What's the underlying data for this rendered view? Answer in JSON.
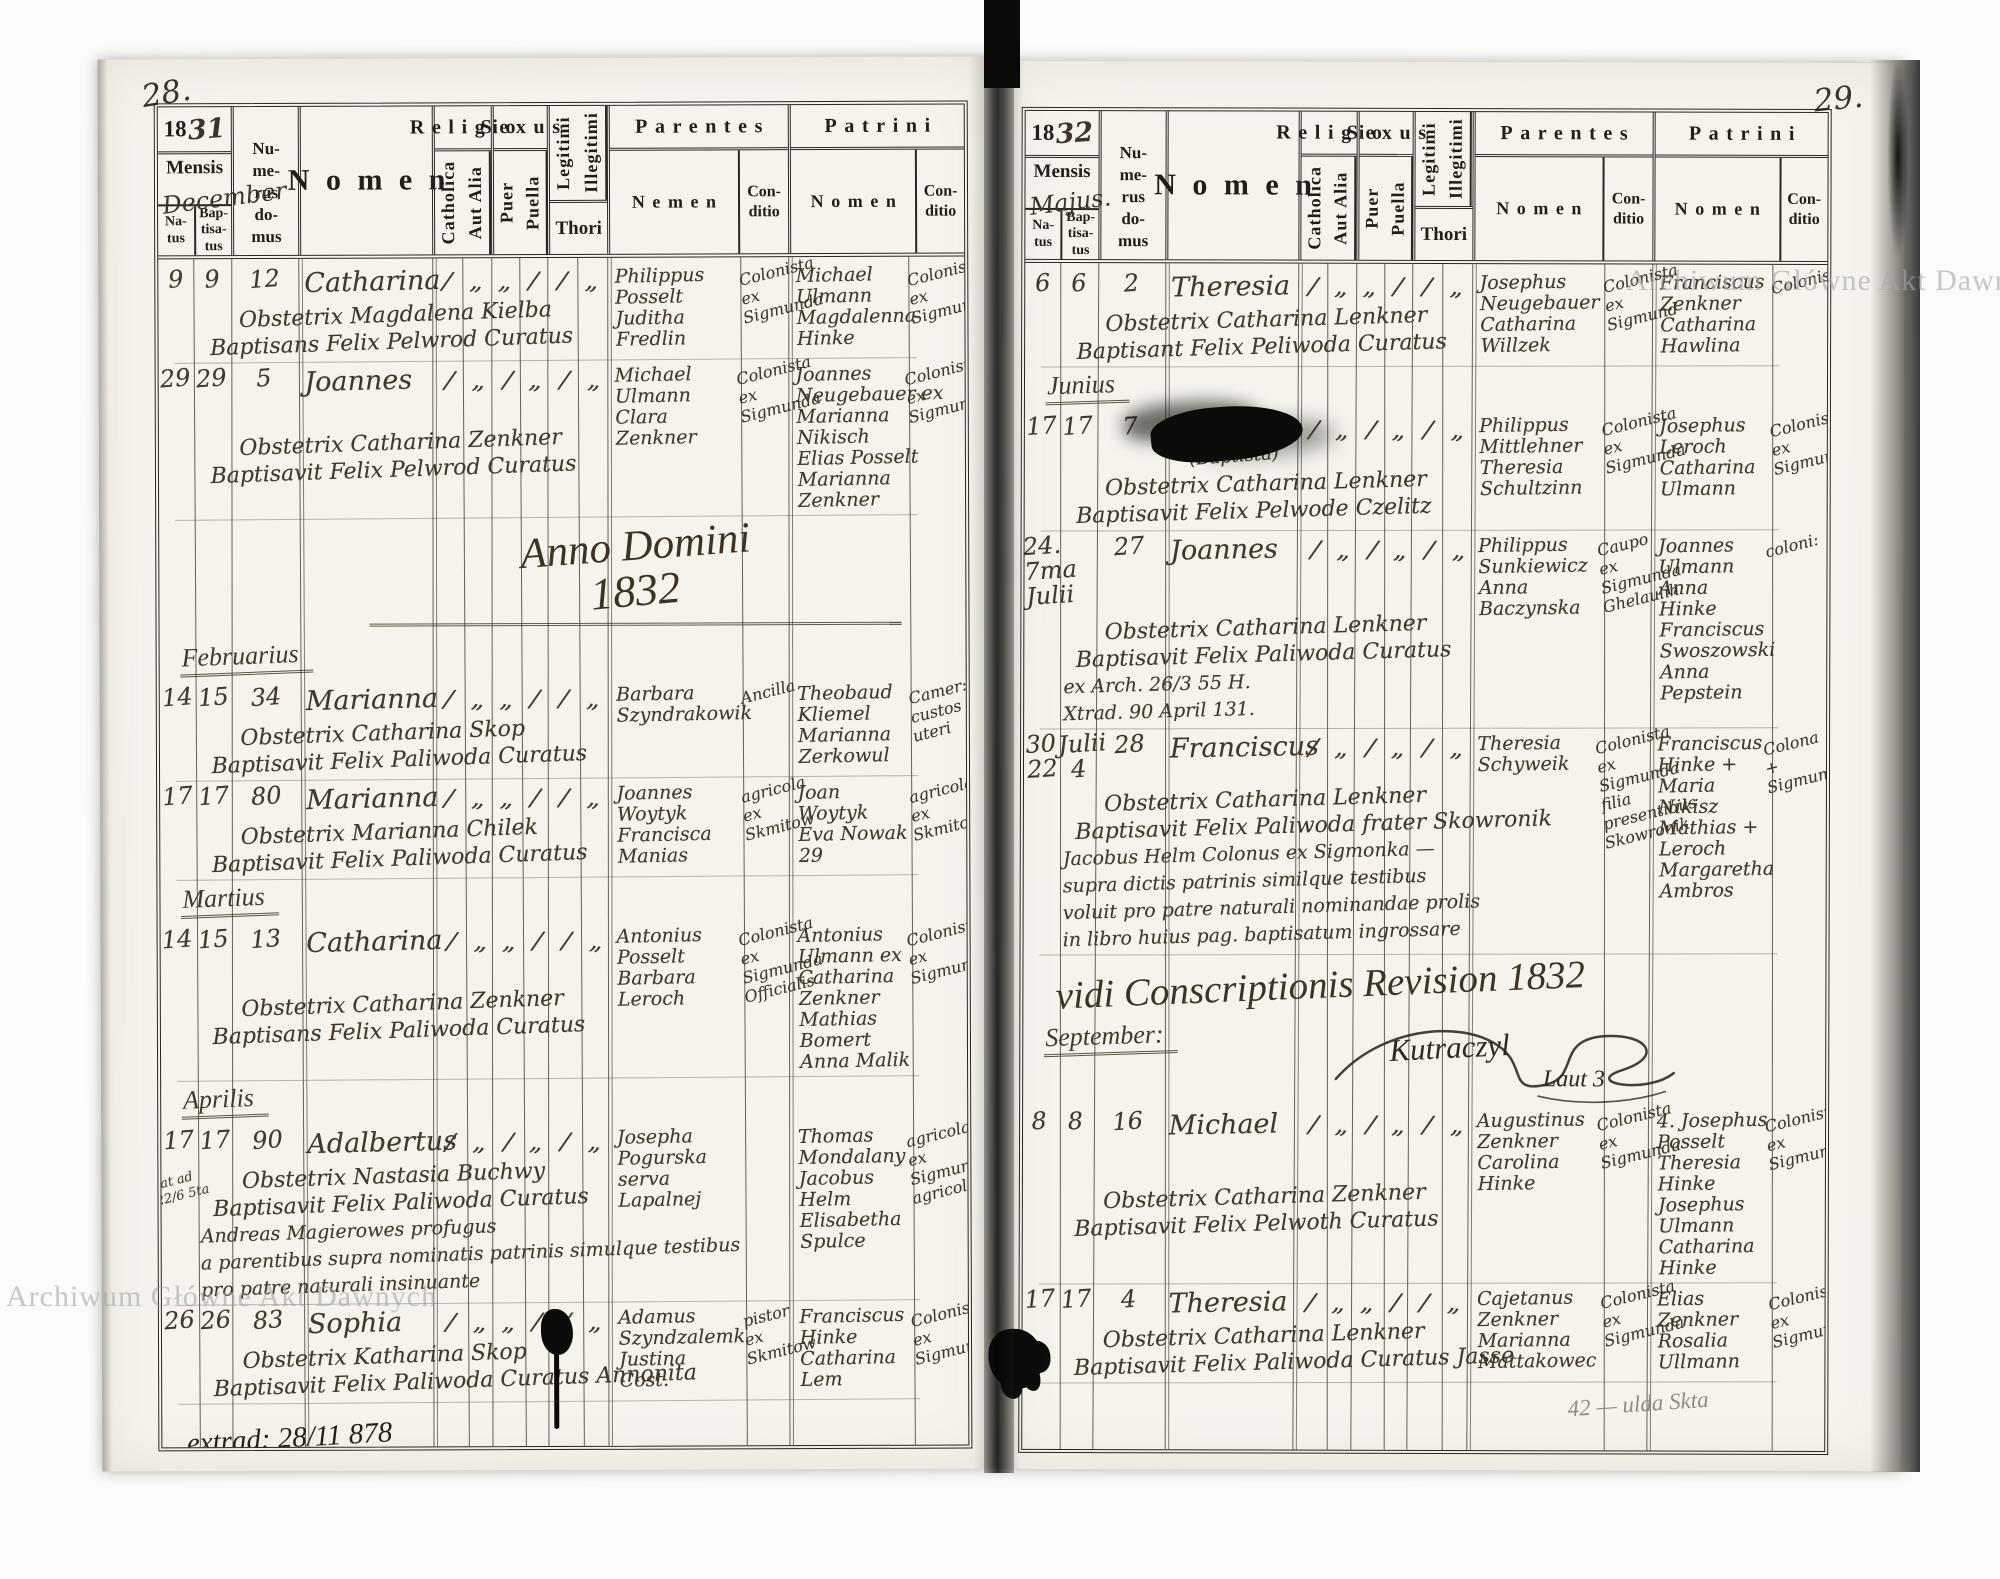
{
  "watermark": "Archiwum Główne Akt Dawnych",
  "labels": {
    "mensis": "Mensis",
    "natus": "Na-\ntus",
    "baptisatus": "Bap-\ntisa-\ntus",
    "numerus_domus": "Nu-\nme-\nrus\ndo-\nmus",
    "nomen": "Nomen",
    "religio": "Religio",
    "catholica": "Catholica",
    "aut_alia": "Aut Alia",
    "sexus": "Sexus",
    "puer": "Puer",
    "puella": "Puella",
    "legitimi": "Legitimi",
    "illegitimi": "Illegitimi",
    "thori": "Thori",
    "parentes": "Parentes",
    "patrini": "Patrini",
    "conditio": "Con-\nditio"
  },
  "pages": [
    {
      "page_number": "28.",
      "year_printed": "18",
      "year_hand": "31",
      "month_written": "December",
      "parentes_nomen_label": "Nemen",
      "patrini_nomen_label": "Nomen",
      "items": [
        {
          "type": "entry",
          "natus": "9",
          "baptisatus": "9",
          "domus": "12",
          "name": "Catharina",
          "lines": [
            "Obstetrix Magdalena Kielba",
            "Baptisans Felix Pelwrod Curatus"
          ],
          "ticks": {
            "catholica": "/",
            "aut_alia": "„",
            "puer": "„",
            "puella": "/",
            "legitimi": "/",
            "illegitimi": "„"
          },
          "parentes": [
            "Philippus",
            "Posselt",
            "Juditha",
            "Fredlin"
          ],
          "parentes_conditio": [
            "Colonista",
            "ex",
            "Sigmunda"
          ],
          "patrini": [
            "Michael",
            "Ulmann",
            "Magdalenna",
            "Hinke"
          ],
          "patrini_conditio": [
            "Colonista",
            "ex",
            "Sigmunda"
          ]
        },
        {
          "type": "entry",
          "natus": "29",
          "baptisatus": "29",
          "domus": "5",
          "name": "Joannes",
          "lines": [
            "Obstetrix Catharina Zenkner",
            "Baptisavit Felix Pelwrod Curatus"
          ],
          "ticks": {
            "catholica": "/",
            "aut_alia": "„",
            "puer": "/",
            "puella": "„",
            "legitimi": "/",
            "illegitimi": "„"
          },
          "parentes": [
            "Michael",
            "Ulmann",
            "Clara",
            "Zenkner"
          ],
          "parentes_conditio": [
            "Colonista",
            "ex",
            "Sigmunda"
          ],
          "patrini": [
            "Joannes",
            "Neugebauer ex",
            "Marianna",
            "Nikisch",
            "Elias Posselt",
            "Marianna",
            "Zenkner"
          ],
          "patrini_conditio": [
            "Colonista",
            "ex",
            "Sigmunda"
          ]
        },
        {
          "type": "heading",
          "text": "Anno Domini",
          "text2": "1832"
        },
        {
          "type": "section",
          "label": "Februarius"
        },
        {
          "type": "entry",
          "natus": "14",
          "baptisatus": "15",
          "domus": "34",
          "name": "Marianna",
          "lines": [
            "Obstetrix Catharina Skop",
            "Baptisavit Felix Paliwoda Curatus"
          ],
          "ticks": {
            "catholica": "/",
            "aut_alia": "„",
            "puer": "„",
            "puella": "/",
            "legitimi": "/",
            "illegitimi": "„"
          },
          "parentes": [
            "Barbara",
            "Szyndrakowik"
          ],
          "parentes_conditio": [
            "Ancilla"
          ],
          "patrini": [
            "Theobaud",
            "Kliemel",
            "Marianna",
            "Zerkowul"
          ],
          "patrini_conditio": [
            "Camer:",
            "custos",
            "uteri"
          ]
        },
        {
          "type": "entry",
          "natus": "17",
          "baptisatus": "17",
          "domus": "80",
          "name": "Marianna",
          "lines": [
            "Obstetrix Marianna Chilek",
            "Baptisavit Felix Paliwoda Curatus"
          ],
          "ticks": {
            "catholica": "/",
            "aut_alia": "„",
            "puer": "„",
            "puella": "/",
            "legitimi": "/",
            "illegitimi": "„"
          },
          "parentes": [
            "Joannes",
            "Woytyk",
            "Francisca",
            "Manias"
          ],
          "parentes_conditio": [
            "agricola",
            "ex",
            "Skmitow"
          ],
          "patrini": [
            "Joan",
            "Woytyk",
            "Eva Nowak",
            "29"
          ],
          "patrini_conditio": [
            "agricola",
            "ex",
            "Skmitow"
          ]
        },
        {
          "type": "section",
          "label": "Martius"
        },
        {
          "type": "entry",
          "natus": "14",
          "baptisatus": "15",
          "domus": "13",
          "name": "Catharina",
          "lines": [
            "Obstetrix Catharina Zenkner",
            "Baptisans Felix Paliwoda Curatus"
          ],
          "ticks": {
            "catholica": "/",
            "aut_alia": "„",
            "puer": "„",
            "puella": "/",
            "legitimi": "/",
            "illegitimi": "„"
          },
          "parentes": [
            "Antonius",
            "Posselt",
            "Barbara",
            "Leroch"
          ],
          "parentes_conditio": [
            "Colonista",
            "ex",
            "Sigmunda",
            "Officialis"
          ],
          "patrini": [
            "Antonius",
            "Ulmann ex",
            "Catharina",
            "Zenkner",
            "Mathias",
            "Bomert",
            "Anna Malik"
          ],
          "patrini_conditio": [
            "Colonista",
            "ex",
            "Sigmunda"
          ]
        },
        {
          "type": "section",
          "label": "Aprilis"
        },
        {
          "type": "entry",
          "natus": "17",
          "baptisatus": "17",
          "domus": "90",
          "name": "Adalbertus",
          "margin_note": "nat ad\n22/6 5ta",
          "lines": [
            "Obstetrix Nastasia Buchwy",
            "Baptisavit Felix Paliwoda Curatus",
            "Andreas Magierowes profugus",
            "a parentibus supra nominatis patrinis simulque testibus",
            "pro patre naturali insinuante"
          ],
          "ticks": {
            "catholica": "/",
            "aut_alia": "„",
            "puer": "/",
            "puella": "„",
            "legitimi": "/",
            "illegitimi": "„"
          },
          "parentes": [
            "Josepha",
            "Pogurska",
            "serva",
            "Lapalnej"
          ],
          "parentes_conditio": [],
          "patrini": [
            "Thomas",
            "Mondalany",
            "Jacobus",
            "Helm",
            "Elisabetha",
            "Spulce"
          ],
          "patrini_conditio": [
            "agricola",
            "ex",
            "Sigmunda",
            "agricola"
          ]
        },
        {
          "type": "entry",
          "natus": "26",
          "baptisatus": "26",
          "domus": "83",
          "name": "Sophia",
          "blot": "drip",
          "lines": [
            "Obstetrix Katharina Skop",
            "Baptisavit Felix Paliwoda Curatus Annonita"
          ],
          "ticks": {
            "catholica": "/",
            "aut_alia": "„",
            "puer": "„",
            "puella": "/",
            "legitimi": "/",
            "illegitimi": "„"
          },
          "parentes": [
            "Adamus",
            "Szyndzalemk",
            "Justina",
            "Cost."
          ],
          "parentes_conditio": [
            "pistor",
            "ex",
            "Skmitow"
          ],
          "patrini": [
            "Franciscus",
            "Hinke",
            "Catharina",
            "Lem"
          ],
          "patrini_conditio": [
            "Colonista",
            "ex",
            "Sigmunda"
          ]
        },
        {
          "type": "note",
          "text": "extrad: 28/11 878"
        }
      ]
    },
    {
      "page_number": "29.",
      "year_printed": "18",
      "year_hand": "32",
      "month_written": "Majus.",
      "parentes_nomen_label": "Nomen",
      "patrini_nomen_label": "Nomen",
      "items": [
        {
          "type": "entry",
          "natus": "6",
          "baptisatus": "6",
          "domus": "2",
          "name": "Theresia",
          "lines": [
            "Obstetrix Catharina Lenkner",
            "Baptisant Felix Peliwoda Curatus"
          ],
          "ticks": {
            "catholica": "/",
            "aut_alia": "„",
            "puer": "„",
            "puella": "/",
            "legitimi": "/",
            "illegitimi": "„"
          },
          "parentes": [
            "Josephus",
            "Neugebauer",
            "Catharina",
            "Willzek"
          ],
          "parentes_conditio": [
            "Colonista",
            "ex",
            "Sigmund"
          ],
          "patrini": [
            "Franciscus",
            "Zenkner",
            "Catharina",
            "Hawlina"
          ],
          "patrini_conditio": [
            "Colonista"
          ]
        },
        {
          "type": "section",
          "label": "Junius"
        },
        {
          "type": "entry",
          "natus": "17",
          "baptisatus": "17",
          "domus": "7",
          "name": "Joannes",
          "name_note": "(Baptista)",
          "blot": "name",
          "lines": [
            "Obstetrix Catharina Lenkner",
            "Baptisavit Felix Pelwode Czelitz"
          ],
          "ticks": {
            "catholica": "/",
            "aut_alia": "„",
            "puer": "/",
            "puella": "„",
            "legitimi": "/",
            "illegitimi": "„"
          },
          "parentes": [
            "Philippus",
            "Mittlehner",
            "Theresia",
            "Schultzinn"
          ],
          "parentes_conditio": [
            "Colonista",
            "ex",
            "Sigmunda"
          ],
          "patrini": [
            "Josephus",
            "Leroch",
            "Catharina",
            "Ulmann"
          ],
          "patrini_conditio": [
            "Colonista",
            "ex",
            "Sigmunda"
          ]
        },
        {
          "type": "entry",
          "natus": "24.\n7ma\nJulii",
          "baptisatus": "",
          "domus": "27",
          "name": "Joannes",
          "lines": [
            "Obstetrix Catharina Lenkner",
            "Baptisavit Felix Paliwoda Curatus",
            "ex Arch. 26/3 55 H.",
            "Xtrad. 90 April 131."
          ],
          "ticks": {
            "catholica": "/",
            "aut_alia": "„",
            "puer": "/",
            "puella": "„",
            "legitimi": "/",
            "illegitimi": "„"
          },
          "parentes": [
            "Philippus",
            "Sunkiewicz",
            "Anna",
            "Baczynska"
          ],
          "parentes_conditio": [
            "Caupo",
            "ex",
            "Sigmunda",
            "Ghelaulih"
          ],
          "patrini": [
            "Joannes",
            "Ulmann",
            "Anna",
            "Hinke",
            "Franciscus",
            "Swoszowski",
            "Anna",
            "Pepstein"
          ],
          "patrini_conditio": [
            "coloni:"
          ]
        },
        {
          "type": "entry",
          "natus": "30\n22",
          "baptisatus": "Julii\n4",
          "domus": "28",
          "name": "Franciscus",
          "lines": [
            "Obstetrix Catharina Lenkner",
            "Baptisavit Felix Paliwoda frater Skowronik",
            "Jacobus Helm Colonus ex Sigmonka —",
            "supra dictis patrinis similque testibus",
            "voluit pro patre naturali nominandae prolis",
            "in libro huius pag. baptisatum ingrossare"
          ],
          "ticks": {
            "catholica": "/",
            "aut_alia": "„",
            "puer": "/",
            "puella": "„",
            "legitimi": "/",
            "illegitimi": "„"
          },
          "parentes": [
            "Theresia",
            "Schyweik"
          ],
          "parentes_conditio": [
            "Colonista",
            "ex",
            "Sigmunda",
            "filia",
            "presentibus",
            "Skowronik"
          ],
          "patrini": [
            "Franciscus",
            "Hinke +",
            "Maria",
            "Nikisz",
            "Mathias +",
            "Leroch",
            "Margaretha",
            "Ambros"
          ],
          "patrini_conditio": [
            "Colona",
            "+",
            "Sigmunka"
          ]
        },
        {
          "type": "heading",
          "text": "vidi Conscriptionis Revision 1832"
        },
        {
          "type": "section",
          "label": "September:"
        },
        {
          "type": "signature",
          "text": "Kutraczyl",
          "text2": "Laut 3"
        },
        {
          "type": "entry",
          "natus": "8",
          "baptisatus": "8",
          "domus": "16",
          "name": "Michael",
          "lines": [
            "Obstetrix Catharina Zenkner",
            "Baptisavit Felix Pelwoth Curatus"
          ],
          "ticks": {
            "catholica": "/",
            "aut_alia": "„",
            "puer": "/",
            "puella": "„",
            "legitimi": "/",
            "illegitimi": "„"
          },
          "parentes": [
            "Augustinus",
            "Zenkner",
            "Carolina",
            "Hinke"
          ],
          "parentes_conditio": [
            "Colonista",
            "ex",
            "Sigmunda"
          ],
          "patrini": [
            "4. Josephus",
            "Posselt",
            "Theresia",
            "Hinke",
            "Josephus",
            "Ulmann",
            "Catharina",
            "Hinke"
          ],
          "patrini_conditio": [
            "Colonista",
            "ex",
            "Sigmunda"
          ]
        },
        {
          "type": "entry",
          "natus": "17",
          "baptisatus": "17",
          "domus": "4",
          "name": "Theresia",
          "lines": [
            "Obstetrix Catharina Lenkner",
            "Baptisavit Felix Paliwoda Curatus Jasse"
          ],
          "ticks": {
            "catholica": "/",
            "aut_alia": "„",
            "puer": "„",
            "puella": "/",
            "legitimi": "/",
            "illegitimi": "„"
          },
          "parentes": [
            "Cajetanus",
            "Zenkner",
            "Marianna",
            "Mattakowec"
          ],
          "parentes_conditio": [
            "Colonista",
            "ex",
            "Sigmunda"
          ],
          "patrini": [
            "Elias",
            "Zenkner",
            "Rosalia",
            "Ullmann"
          ],
          "patrini_conditio": [
            "Colonista",
            "ex",
            "Sigmunda"
          ]
        },
        {
          "type": "pencil",
          "text": "42 — ulda Skta"
        }
      ]
    }
  ]
}
